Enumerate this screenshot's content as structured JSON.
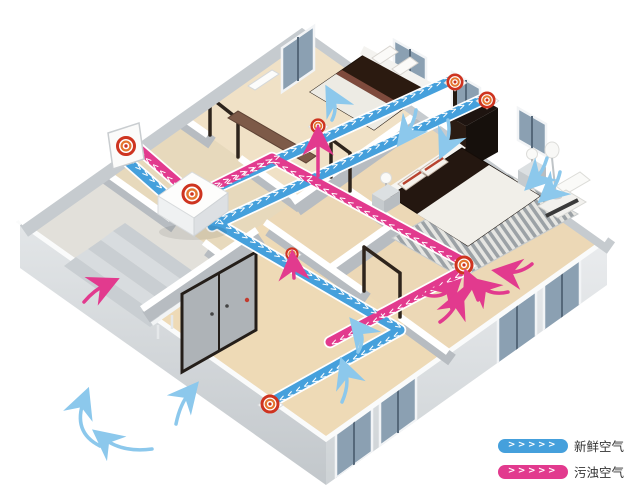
{
  "figure": {
    "type": "isometric-home-ventilation-diagram"
  },
  "legend": {
    "items": [
      {
        "id": "fresh-air",
        "label": "新鲜空气",
        "color": "#45A0DC",
        "chevrons": ">>>>>"
      },
      {
        "id": "exhaust-air",
        "label": "污浊空气",
        "color": "#E23A8E",
        "chevrons": ">>>>>"
      }
    ]
  },
  "ducts": {
    "fresh_color": "#45A0DC",
    "exhaust_color": "#E23A8E",
    "chevrons": ">>>>>>>>>>>>>>>>>>>>>>>>>>>>>>>>>>>>>>>>>>>>>>>>>>>>>>>>"
  },
  "icons": {
    "vent": "round-diffuser-vent-icon",
    "unit": "heat-recovery-ventilator-unit",
    "wall_vent": "exterior-wall-vent-icon",
    "vent_locations": [
      "exterior-wall-vent",
      "hrv-unit-top-logo",
      "bedroom1-ceiling-supply-vent",
      "bedroom2-ceiling-supply-vent",
      "hallway-exhaust-vent",
      "corridor-exhaust-vent",
      "master-bedroom-exhaust-vent",
      "living-room-supply-vent"
    ]
  },
  "colors": {
    "floor": "#E7D9BC",
    "wall_top": "#FFFFFF",
    "wall_face": "#B7BCC1",
    "exterior_face": "#C9CED2",
    "bed_wood": "#2B1A10",
    "window_glass": "#8BA0B2",
    "light_arrow_blue": "#8CC8EC",
    "vent_red": "#CE3420",
    "vent_orange": "#E4762E"
  }
}
